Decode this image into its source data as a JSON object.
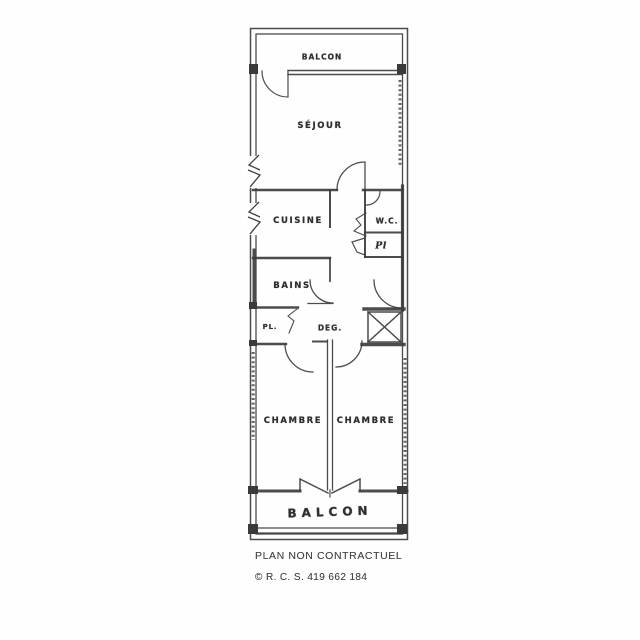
{
  "colors": {
    "line": "#3d3d3d",
    "label_text": "#2e2e2e",
    "footer_text": "#45464a",
    "background": "#fefefe"
  },
  "plan": {
    "rooms": {
      "balcon_top": "BALCON",
      "sejour": "SÉJOUR",
      "cuisine": "CUISINE",
      "wc": "W.C.",
      "placard_right": "Pl",
      "bains": "BAINS",
      "placard_left": "PL.",
      "degagement": "DEG.",
      "chambre_left": "CHAMBRE",
      "chambre_right": "CHAMBRE",
      "balcon_bottom": "BALCON"
    }
  },
  "footer": {
    "disclaimer": "PLAN NON CONTRACTUEL",
    "rcs": "© R. C. S. 419 662 184"
  }
}
